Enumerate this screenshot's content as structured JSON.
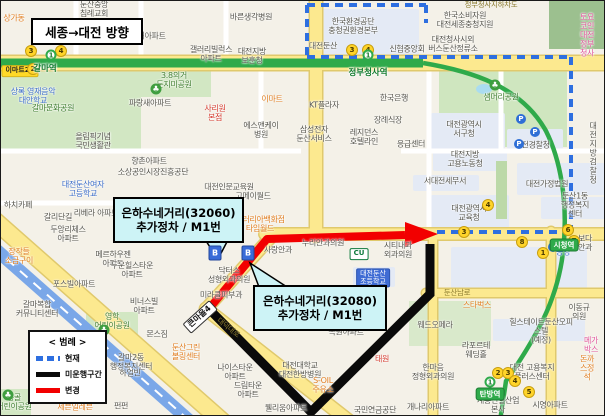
{
  "direction_box": {
    "label": "세종→대전 방향"
  },
  "callouts": [
    {
      "line1": "은하수네거리(32060)",
      "line2": "추가정차 / M1번"
    },
    {
      "line1": "은하수네거리(32080)",
      "line2": "추가정차 / M1번"
    }
  ],
  "legend": {
    "title": "< 범례 >",
    "items": [
      {
        "label": "현재",
        "style": "dashed",
        "color": "#2e6fe0"
      },
      {
        "label": "미운행구간",
        "style": "solid",
        "color": "#0a0a0a"
      },
      {
        "label": "변경",
        "style": "solid",
        "color": "#f20000"
      }
    ]
  },
  "subway": {
    "line_color": "#2faa4a",
    "line_number": "1"
  },
  "stations": [
    {
      "n": "갈마역",
      "x": 44,
      "y": 67,
      "bx": 50,
      "by": 54,
      "big": true
    },
    {
      "n": "정부청사역",
      "x": 367,
      "y": 71,
      "bx": 367,
      "by": 54,
      "big": true
    },
    {
      "n": "시청역",
      "x": 563,
      "y": 244
    },
    {
      "n": "탄방역",
      "x": 489,
      "y": 393,
      "bx": 489,
      "by": 381
    }
  ],
  "map_labels": [
    {
      "t": "둔산중앙\n침례교회",
      "x": 93,
      "y": 9
    },
    {
      "t": "상가동",
      "x": 13,
      "y": 18,
      "c": "o"
    },
    {
      "t": "지개아파트",
      "x": 147,
      "y": 36
    },
    {
      "t": "바른생각병원",
      "x": 250,
      "y": 17
    },
    {
      "t": "한국환경공단\n충청권환경본부",
      "x": 352,
      "y": 26
    },
    {
      "t": "대전둔산",
      "x": 322,
      "y": 46
    },
    {
      "t": "신협중앙회",
      "x": 406,
      "y": 49
    },
    {
      "t": "갤러리빌럭스\n아파트",
      "x": 210,
      "y": 54
    },
    {
      "t": "대전지방\n보훈청",
      "x": 251,
      "y": 56
    },
    {
      "t": "한국소비자원\n대전세종충청지원",
      "x": 464,
      "y": 20
    },
    {
      "t": "대전청사시외\n버스둔산정류소",
      "x": 452,
      "y": 44
    },
    {
      "t": "토요코인\n대전정부청사",
      "x": 586,
      "y": 35,
      "c": "p"
    },
    {
      "t": "정부청사지하차도",
      "x": 490,
      "y": 4,
      "c": "road"
    },
    {
      "t": "3.8의거\n둔지미공원",
      "x": 173,
      "y": 80,
      "c": "gr"
    },
    {
      "t": "상록 영재음악\n대안학교",
      "x": 32,
      "y": 96,
      "c": "b"
    },
    {
      "t": "갈마문화공원",
      "x": 52,
      "y": 108,
      "c": "gr"
    },
    {
      "t": "파랑새아파트",
      "x": 149,
      "y": 103
    },
    {
      "t": "올림픽기념\n국민생활관",
      "x": 92,
      "y": 141
    },
    {
      "t": "샘머리공원",
      "x": 500,
      "y": 97,
      "c": "gr"
    },
    {
      "t": "한국은행",
      "x": 393,
      "y": 98
    },
    {
      "t": "이마트",
      "x": 271,
      "y": 99,
      "c": "o"
    },
    {
      "t": "KT플라자",
      "x": 323,
      "y": 105
    },
    {
      "t": "사리원\n본점",
      "x": 214,
      "y": 113,
      "c": "r"
    },
    {
      "t": "에스앤케이\n병원",
      "x": 260,
      "y": 130
    },
    {
      "t": "삼성전자\n둔산서비스",
      "x": 313,
      "y": 134
    },
    {
      "t": "레지던스\n호텔라인",
      "x": 363,
      "y": 137
    },
    {
      "t": "장례식장",
      "x": 387,
      "y": 120
    },
    {
      "t": "응급센터",
      "x": 410,
      "y": 144
    },
    {
      "t": "대전광역시\n서구청",
      "x": 463,
      "y": 129
    },
    {
      "t": "대전경찰청",
      "x": 531,
      "y": 145
    },
    {
      "t": "대전지방검찰청",
      "x": 592,
      "y": 153
    },
    {
      "t": "대전지방\n고용노동청",
      "x": 464,
      "y": 159
    },
    {
      "t": "서대전세무서",
      "x": 444,
      "y": 181
    },
    {
      "t": "대전가정법원",
      "x": 546,
      "y": 184
    },
    {
      "t": "둔산1동\n행정복지센터",
      "x": 574,
      "y": 205
    },
    {
      "t": "대전광역시\n교육청",
      "x": 468,
      "y": 213
    },
    {
      "t": "향촌아파트",
      "x": 148,
      "y": 161
    },
    {
      "t": "소상공인시장진흥공단",
      "x": 152,
      "y": 172
    },
    {
      "t": "대전인문교육원",
      "x": 228,
      "y": 187
    },
    {
      "t": "고메이월드",
      "x": 252,
      "y": 196
    },
    {
      "t": "갤러리아백화점\n타임월드",
      "x": 259,
      "y": 224,
      "c": "o"
    },
    {
      "t": "대전둔산여자\n고등학교",
      "x": 82,
      "y": 189,
      "c": "b"
    },
    {
      "t": "하치카페",
      "x": 17,
      "y": 205
    },
    {
      "t": "갈리단길",
      "x": 57,
      "y": 217
    },
    {
      "t": "리베라 아파트",
      "x": 95,
      "y": 213
    },
    {
      "t": "두앙리체스\n아파트",
      "x": 67,
      "y": 234
    },
    {
      "t": "메르하우젠\n아파트",
      "x": 112,
      "y": 259
    },
    {
      "t": "두운힐스타운\n아파트",
      "x": 131,
      "y": 270
    },
    {
      "t": "장작들\n소금구이",
      "x": 18,
      "y": 256,
      "c": "o"
    },
    {
      "t": "포스빌아파트",
      "x": 73,
      "y": 284
    },
    {
      "t": "누리안과의원",
      "x": 322,
      "y": 243
    },
    {
      "t": "사랑안과",
      "x": 277,
      "y": 250
    },
    {
      "t": "시티내과\n외과의원",
      "x": 397,
      "y": 250
    },
    {
      "t": "닥터스\n성형외과의원",
      "x": 228,
      "y": 275
    },
    {
      "t": "미라클피부과",
      "x": 220,
      "y": 295
    },
    {
      "t": "치과의원",
      "x": 267,
      "y": 327
    },
    {
      "t": "녹원아파트",
      "x": 345,
      "y": 332
    },
    {
      "t": "대덕대로",
      "x": 227,
      "y": 327,
      "c": "road",
      "r": 38
    },
    {
      "t": "나이스타운\n아파트",
      "x": 234,
      "y": 372
    },
    {
      "t": "드림타운\n아파트",
      "x": 247,
      "y": 390
    },
    {
      "t": "대전대학교\n대전한방병원",
      "x": 299,
      "y": 370
    },
    {
      "t": "S-OIL\n주유소",
      "x": 322,
      "y": 385,
      "c": "o"
    },
    {
      "t": "웰리움아파트",
      "x": 285,
      "y": 408
    },
    {
      "t": "국민연금공단",
      "x": 374,
      "y": 410
    },
    {
      "t": "태원",
      "x": 381,
      "y": 359,
      "c": "r"
    },
    {
      "t": "갈마복합\n커뮤니티센터",
      "x": 36,
      "y": 309
    },
    {
      "t": "영학\n어린이공원",
      "x": 111,
      "y": 321,
      "c": "gr"
    },
    {
      "t": "몬스짐",
      "x": 156,
      "y": 334
    },
    {
      "t": "비너스빌\n아파트",
      "x": 143,
      "y": 306
    },
    {
      "t": "둔산그린\n볼링센터",
      "x": 185,
      "y": 352,
      "c": "o"
    },
    {
      "t": "갈마2동\n행정복지센터",
      "x": 130,
      "y": 362
    },
    {
      "t": "하얼빈",
      "x": 129,
      "y": 373
    },
    {
      "t": "펀펀",
      "x": 120,
      "y": 406
    },
    {
      "t": "세븐일레븐",
      "x": 74,
      "y": 407,
      "c": "o"
    },
    {
      "t": "능골\n어린이공원",
      "x": 13,
      "y": 402,
      "c": "gr"
    },
    {
      "t": "둔산남로",
      "x": 456,
      "y": 292,
      "c": "road"
    },
    {
      "t": "스타벅스",
      "x": 476,
      "y": 305,
      "c": "o"
    },
    {
      "t": "이동규의원",
      "x": 578,
      "y": 312
    },
    {
      "t": "웨드오페라",
      "x": 434,
      "y": 325
    },
    {
      "t": "힐스테이트둔산오피스텔\n(예정)",
      "x": 540,
      "y": 331
    },
    {
      "t": "메가박스",
      "x": 590,
      "y": 345,
      "c": "p"
    },
    {
      "t": "라포르테\n웨딩홀",
      "x": 475,
      "y": 350
    },
    {
      "t": "한마음\n정형외과의원",
      "x": 432,
      "y": 372
    },
    {
      "t": "대전 고용복지\n플러스센터",
      "x": 531,
      "y": 372
    },
    {
      "t": "돈까스정석",
      "x": 586,
      "y": 368,
      "c": "o"
    },
    {
      "t": "계룡건설산업\n본사",
      "x": 497,
      "y": 405
    },
    {
      "t": "개나리아파트",
      "x": 427,
      "y": 407
    },
    {
      "t": "시영아파트",
      "x": 549,
      "y": 405
    },
    {
      "t": "보다안과",
      "x": 584,
      "y": 243
    },
    {
      "t": "공영",
      "x": 562,
      "y": 252,
      "c": "b"
    }
  ],
  "chips": [
    {
      "t": "이마트24",
      "x": 19,
      "y": 70,
      "c": "cy"
    },
    {
      "t": "CU",
      "x": 358,
      "y": 253,
      "c": "cu"
    },
    {
      "t": "대전둔산\n초등학교",
      "x": 372,
      "y": 277,
      "c": "cs"
    },
    {
      "t": "큰마을4",
      "x": 199,
      "y": 316,
      "c": "sign",
      "r": -42
    }
  ],
  "stop_badges": [
    {
      "n": "3",
      "x": 30,
      "y": 50
    },
    {
      "n": "4",
      "x": 60,
      "y": 50
    },
    {
      "n": "2",
      "x": 32,
      "y": 68
    },
    {
      "n": "3",
      "x": 351,
      "y": 49
    },
    {
      "n": "4",
      "x": 367,
      "y": 49
    },
    {
      "n": "4",
      "x": 487,
      "y": 204
    },
    {
      "n": "3",
      "x": 463,
      "y": 231
    },
    {
      "n": "6",
      "x": 567,
      "y": 229
    },
    {
      "n": "7",
      "x": 573,
      "y": 240
    },
    {
      "n": "8",
      "x": 521,
      "y": 241
    },
    {
      "n": "1",
      "x": 542,
      "y": 252
    },
    {
      "n": "2",
      "x": 497,
      "y": 372
    },
    {
      "n": "3",
      "x": 507,
      "y": 372
    },
    {
      "n": "4",
      "x": 514,
      "y": 380
    },
    {
      "n": "5",
      "x": 528,
      "y": 391
    }
  ],
  "parking_badges": [
    {
      "x": 520,
      "y": 118
    },
    {
      "x": 534,
      "y": 131
    },
    {
      "x": 518,
      "y": 143
    },
    {
      "x": 552,
      "y": 246
    }
  ],
  "park_icons": [
    {
      "x": 155,
      "y": 88
    },
    {
      "x": 494,
      "y": 84
    },
    {
      "x": 103,
      "y": 329
    },
    {
      "x": 7,
      "y": 394
    }
  ],
  "bus_stops": [
    {
      "x": 214,
      "y": 252
    },
    {
      "x": 247,
      "y": 252
    }
  ]
}
